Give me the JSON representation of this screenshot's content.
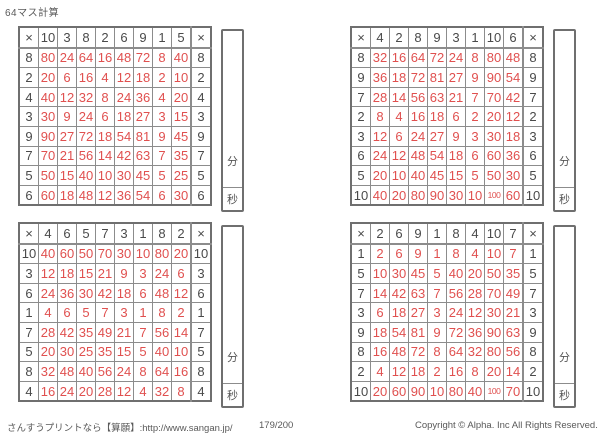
{
  "page": {
    "title": "64マス計算",
    "operator": "×",
    "time_labels": {
      "minutes": "分",
      "seconds": "秒"
    },
    "footer": {
      "site": "さんすうプリントなら【算願】:http://www.sangan.jp/",
      "page_number": "179/200",
      "copyright": "Copyright © Alpha. Inc All Rights Reserved."
    },
    "colors": {
      "answer_red": "#e0504f",
      "header_text": "#4a4a4a",
      "outer_border": "#6f6f6f",
      "inner_border": "#8c8c8c"
    }
  },
  "grids": [
    {
      "position": "top-left",
      "cols": [
        10,
        3,
        8,
        2,
        6,
        9,
        1,
        5
      ],
      "rows": [
        8,
        2,
        4,
        3,
        9,
        7,
        5,
        6
      ],
      "answers": [
        [
          80,
          24,
          64,
          16,
          48,
          72,
          8,
          40
        ],
        [
          20,
          6,
          16,
          4,
          12,
          18,
          2,
          10
        ],
        [
          40,
          12,
          32,
          8,
          24,
          36,
          4,
          20
        ],
        [
          30,
          9,
          24,
          6,
          18,
          27,
          3,
          15
        ],
        [
          90,
          27,
          72,
          18,
          54,
          81,
          9,
          45
        ],
        [
          70,
          21,
          56,
          14,
          42,
          63,
          7,
          35
        ],
        [
          50,
          15,
          40,
          10,
          30,
          45,
          5,
          25
        ],
        [
          60,
          18,
          48,
          12,
          36,
          54,
          6,
          30
        ]
      ]
    },
    {
      "position": "top-right",
      "cols": [
        4,
        2,
        8,
        9,
        3,
        1,
        10,
        6
      ],
      "rows": [
        8,
        9,
        7,
        2,
        3,
        6,
        5,
        10
      ],
      "answers": [
        [
          32,
          16,
          64,
          72,
          24,
          8,
          80,
          48
        ],
        [
          36,
          18,
          72,
          81,
          27,
          9,
          90,
          54
        ],
        [
          28,
          14,
          56,
          63,
          21,
          7,
          70,
          42
        ],
        [
          8,
          4,
          16,
          18,
          6,
          2,
          20,
          12
        ],
        [
          12,
          6,
          24,
          27,
          9,
          3,
          30,
          18
        ],
        [
          24,
          12,
          48,
          54,
          18,
          6,
          60,
          36
        ],
        [
          20,
          10,
          40,
          45,
          15,
          5,
          50,
          30
        ],
        [
          40,
          20,
          80,
          90,
          30,
          10,
          100,
          60
        ]
      ]
    },
    {
      "position": "bottom-left",
      "cols": [
        4,
        6,
        5,
        7,
        3,
        1,
        8,
        2
      ],
      "rows": [
        10,
        3,
        6,
        1,
        7,
        5,
        8,
        4
      ],
      "answers": [
        [
          40,
          60,
          50,
          70,
          30,
          10,
          80,
          20
        ],
        [
          12,
          18,
          15,
          21,
          9,
          3,
          24,
          6
        ],
        [
          24,
          36,
          30,
          42,
          18,
          6,
          48,
          12
        ],
        [
          4,
          6,
          5,
          7,
          3,
          1,
          8,
          2
        ],
        [
          28,
          42,
          35,
          49,
          21,
          7,
          56,
          14
        ],
        [
          20,
          30,
          25,
          35,
          15,
          5,
          40,
          10
        ],
        [
          32,
          48,
          40,
          56,
          24,
          8,
          64,
          16
        ],
        [
          16,
          24,
          20,
          28,
          12,
          4,
          32,
          8
        ]
      ]
    },
    {
      "position": "bottom-right",
      "cols": [
        2,
        6,
        9,
        1,
        8,
        4,
        10,
        7
      ],
      "rows": [
        1,
        5,
        7,
        3,
        9,
        8,
        2,
        10
      ],
      "answers": [
        [
          2,
          6,
          9,
          1,
          8,
          4,
          10,
          7
        ],
        [
          10,
          30,
          45,
          5,
          40,
          20,
          50,
          35
        ],
        [
          14,
          42,
          63,
          7,
          56,
          28,
          70,
          49
        ],
        [
          6,
          18,
          27,
          3,
          24,
          12,
          30,
          21
        ],
        [
          18,
          54,
          81,
          9,
          72,
          36,
          90,
          63
        ],
        [
          16,
          48,
          72,
          8,
          64,
          32,
          80,
          56
        ],
        [
          4,
          12,
          18,
          2,
          16,
          8,
          20,
          14
        ],
        [
          20,
          60,
          90,
          10,
          80,
          40,
          100,
          70
        ]
      ]
    }
  ]
}
